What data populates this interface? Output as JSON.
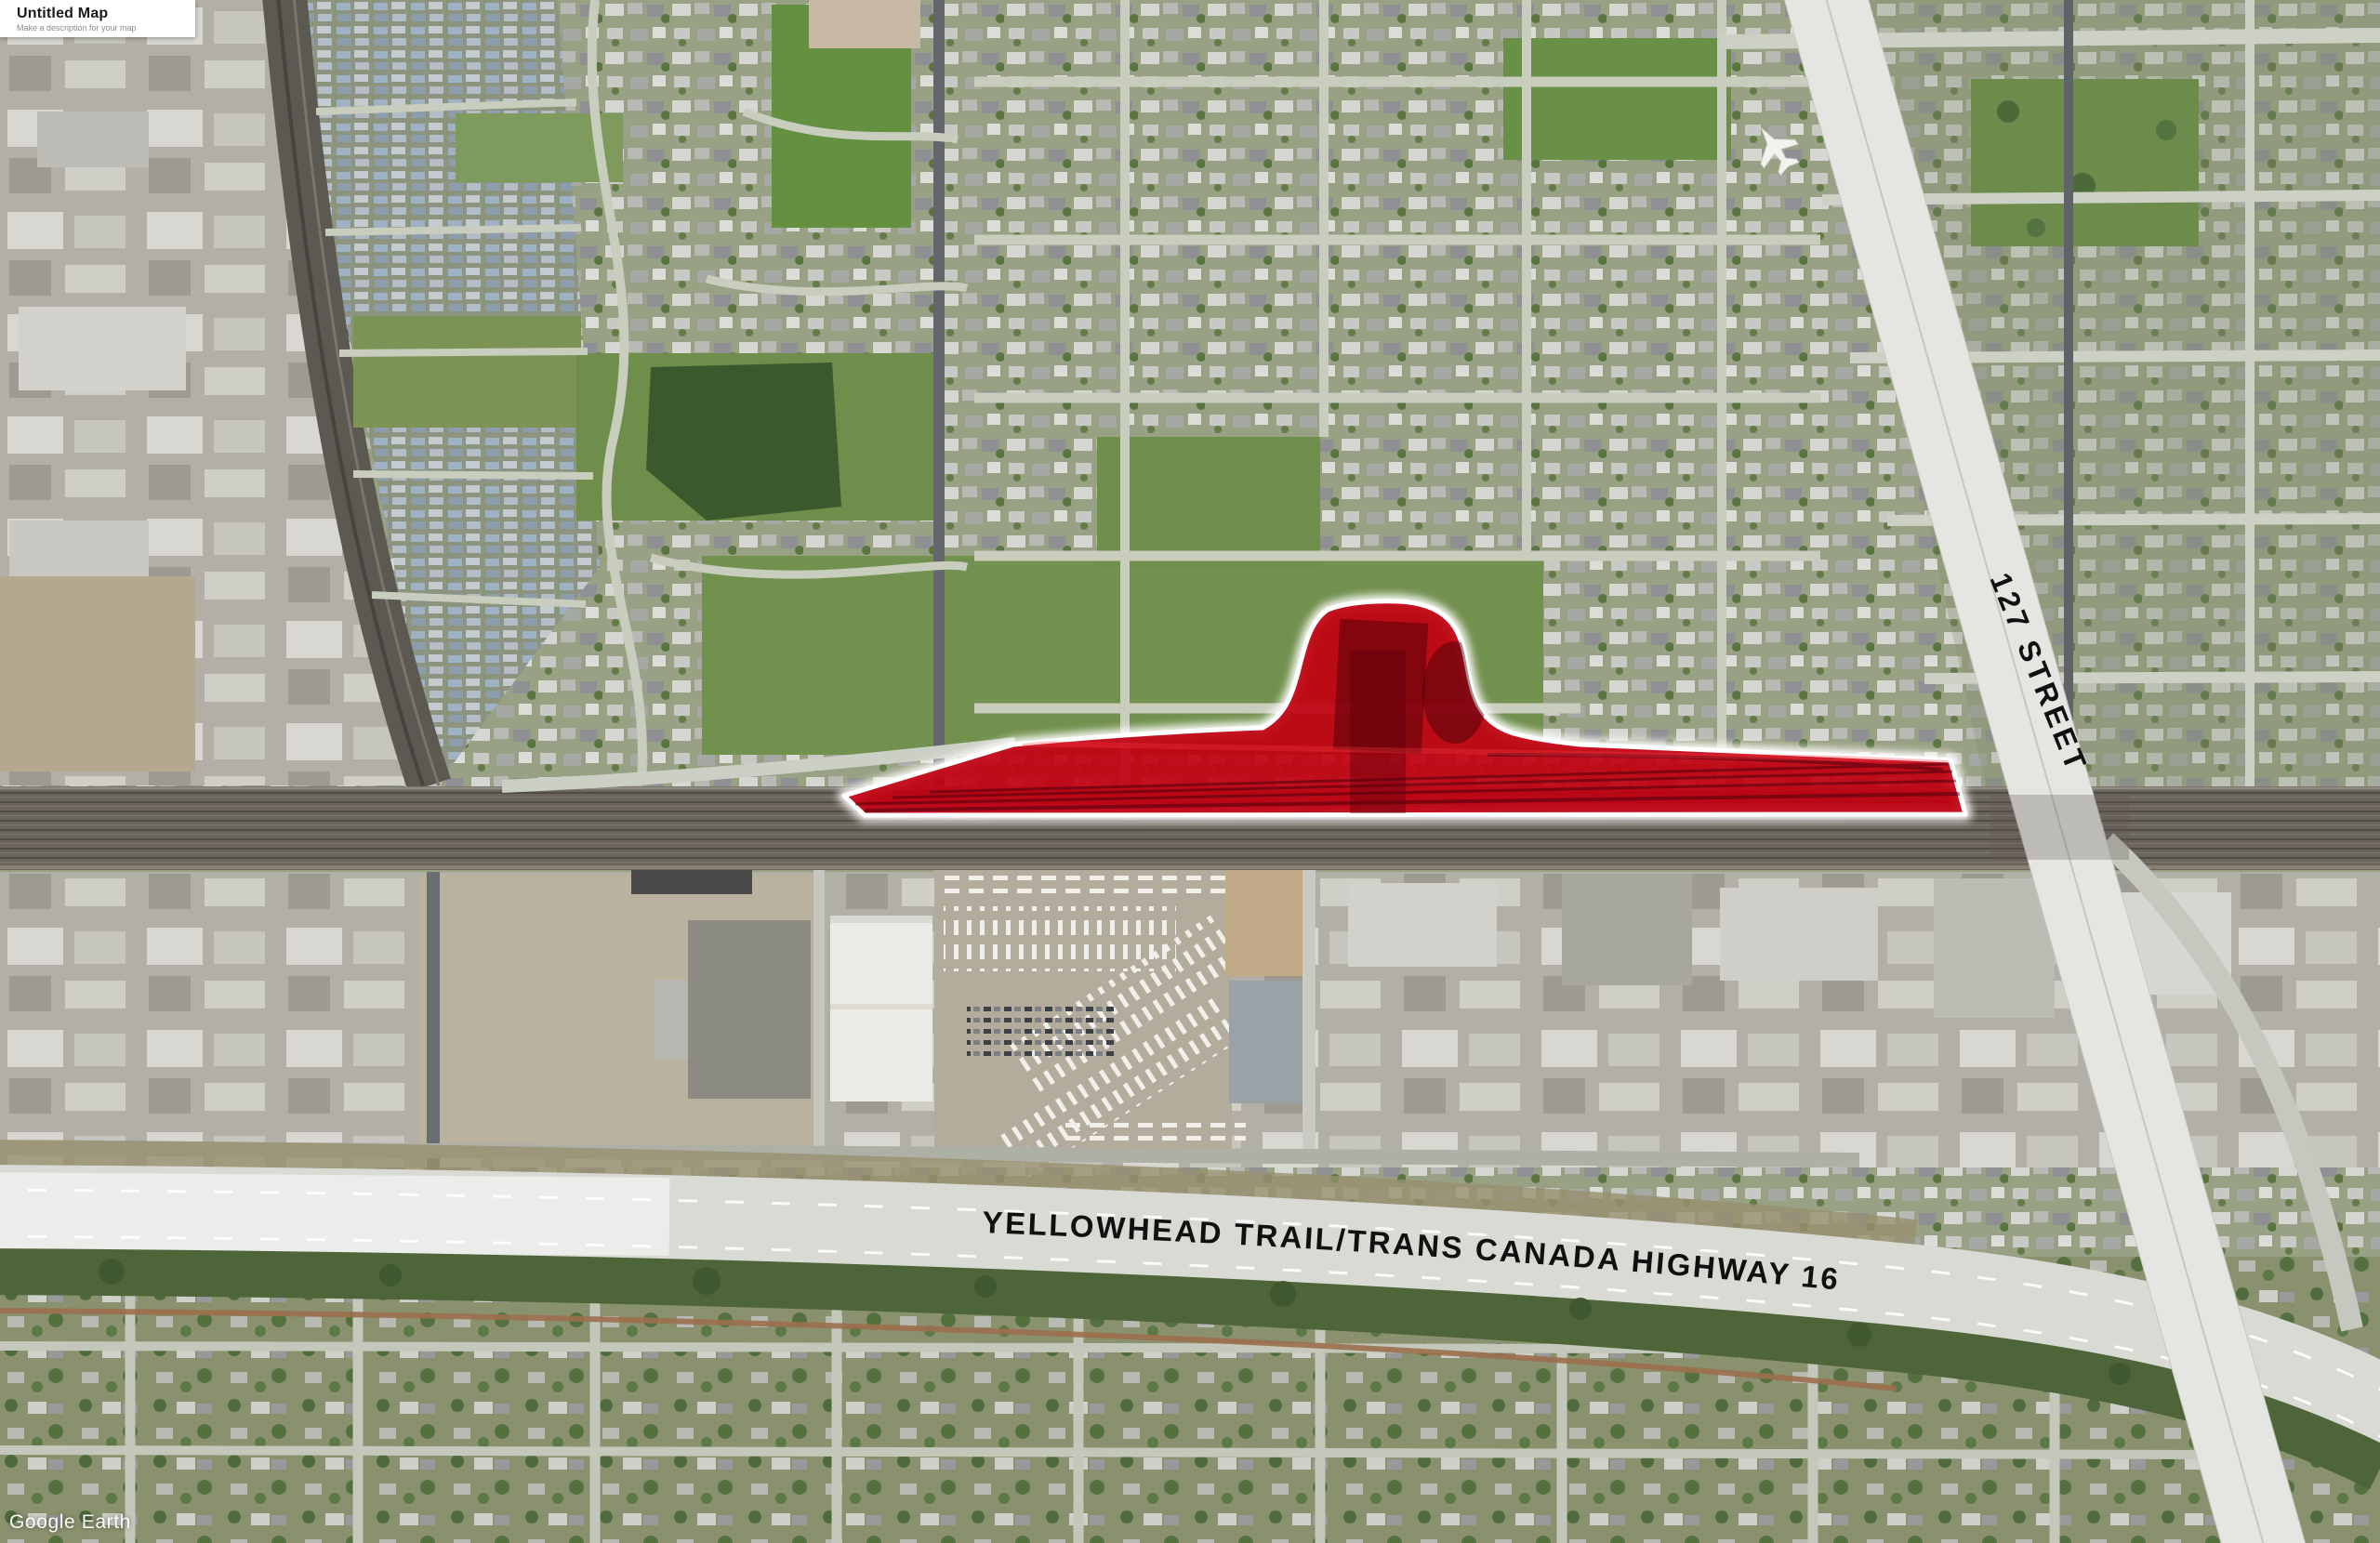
{
  "panel": {
    "title": "Untitled Map",
    "description": "Make a description for your map"
  },
  "watermark": "Google Earth",
  "map_labels": {
    "street": "127 STREET",
    "highway": "YELLOWHEAD TRAIL/TRANS CANADA HIGHWAY 16"
  },
  "site": {
    "name": "highlighted rail-yard parcel",
    "fill_color": "#c10010",
    "outline_color": "#ffffff"
  },
  "scene": {
    "imagery": "aerial satellite view, Edmonton area",
    "rail_corridor_color": "#6b655d",
    "highway_color": "#d9dad4",
    "field_color": "#6f8d4b",
    "forest_color": "#3a5a2e"
  }
}
